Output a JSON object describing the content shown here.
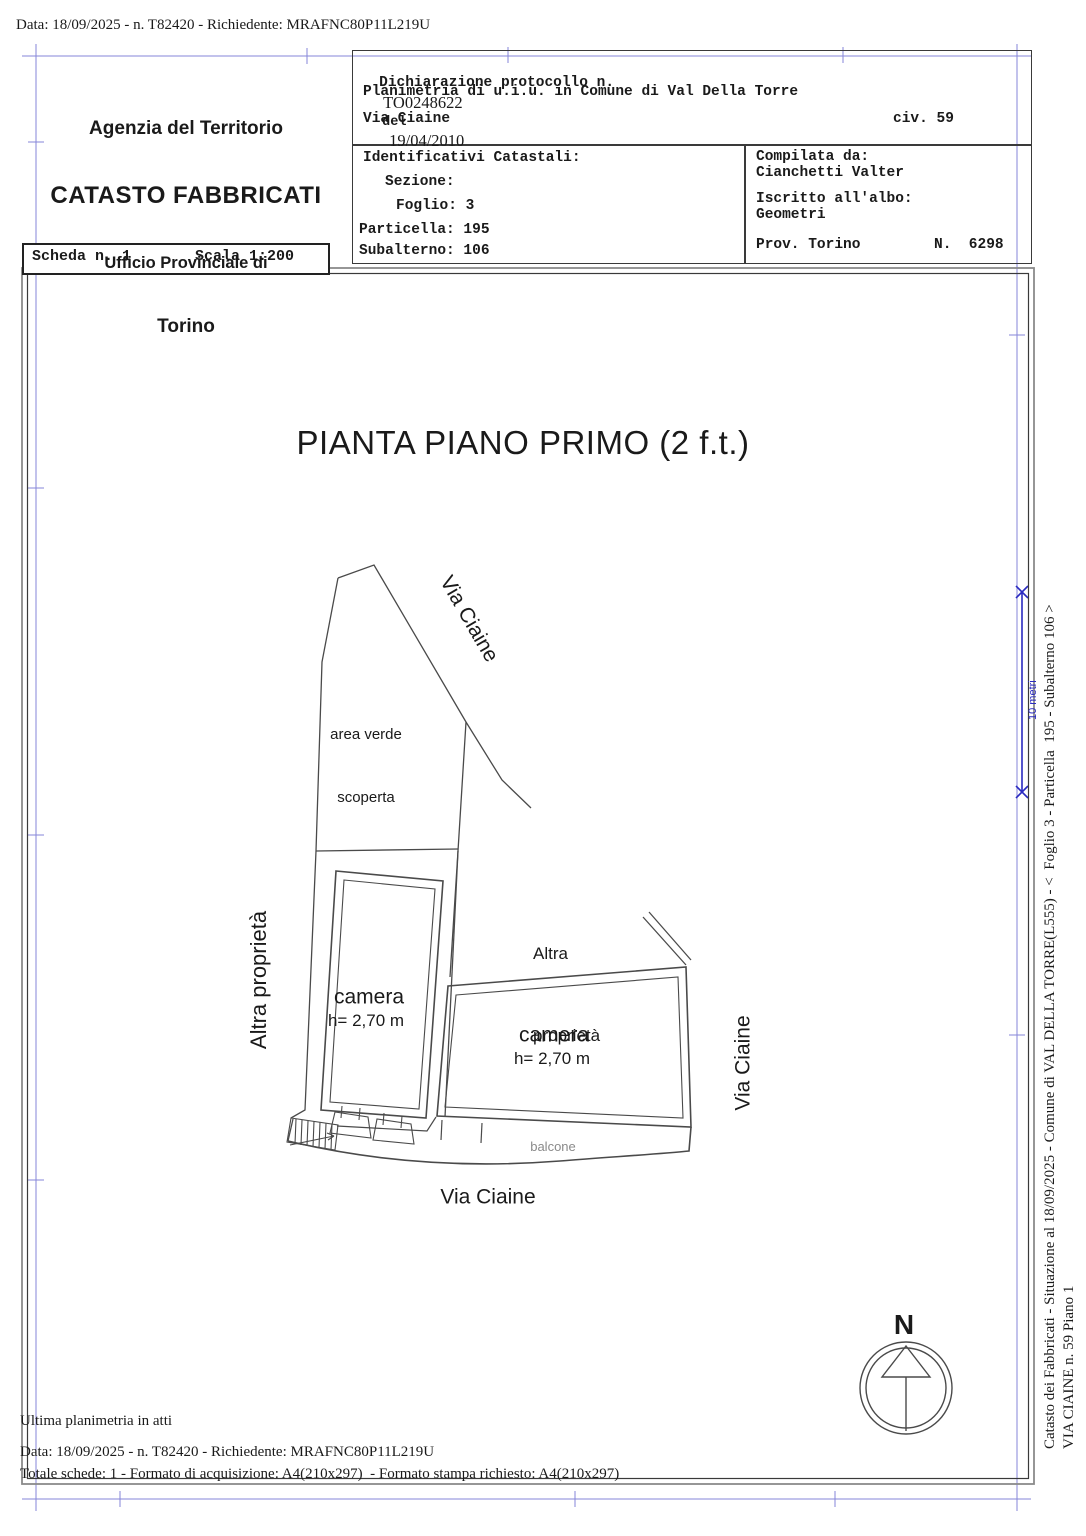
{
  "top_line": "Data: 18/09/2025 - n. T82420 - Richiedente: MRAFNC80P11L219U",
  "header": {
    "agency": {
      "line1": "Agenzia del Territorio",
      "line2": "CATASTO FABBRICATI",
      "line3": "Ufficio Provinciale di",
      "line4": "Torino"
    },
    "declaration": {
      "label": "Dichiarazione protocollo n.",
      "protocol": "TO0248622",
      "del": "del",
      "date": "19/04/2010",
      "line2": "Planimetria di u.i.u. in Comune di Val Della Torre",
      "street": "Via Ciaine",
      "civ": "civ. 59"
    },
    "identifiers": {
      "title": "Identificativi Catastali:",
      "sezione": "Sezione:",
      "foglio": "Foglio: 3",
      "particella": "Particella: 195",
      "subalterno": "Subalterno: 106"
    },
    "compiler": {
      "label": "Compilata da:",
      "name": "Cianchetti Valter",
      "albo_label": "Iscritto all'albo:",
      "albo": "Geometri",
      "prov": "Prov. Torino",
      "num": "N.  6298"
    },
    "scheda": {
      "scheda": "Scheda n. 1",
      "scala": "Scala 1:200"
    }
  },
  "plan": {
    "title": "PIANTA PIANO PRIMO (2 f.t.)",
    "labels": {
      "via_ciaine_top": "Via Ciaine",
      "area_verde_1": "area verde",
      "area_verde_2": "scoperta",
      "altra_prop_left": "Altra proprietà",
      "altra_prop_right_1": "Altra",
      "altra_prop_right_2": "proprietà",
      "camera1": "camera",
      "camera1_h": "h= 2,70 m",
      "camera2": "camera",
      "camera2_h": "h= 2,70 m",
      "balcone": "balcone",
      "via_ciaine_right": "Via Ciaine",
      "via_ciaine_bottom": "Via Ciaine",
      "north": "N"
    },
    "scale_bar_label": "10 metri"
  },
  "footer": {
    "line1": "Ultima planimetria in atti",
    "line2": "Data: 18/09/2025 - n. T82420 - Richiedente: MRAFNC80P11L219U",
    "line3": "Totale schede: 1 - Formato di acquisizione: A4(210x297)  - Formato stampa richiesto: A4(210x297)"
  },
  "sidebar": {
    "line1": "Catasto dei Fabbricati - Situazione al 18/09/2025 - Comune di VAL DELLA TORRE(L555) - <  Foglio 3 - Particella  195 - Subalterno 106 >",
    "line2": "VIA CIAINE n. 59 Piano 1"
  },
  "colors": {
    "frame_blue": "#8686d8",
    "scalebar_blue": "#2a2ac0",
    "ink": "#1a1a1a",
    "plan_line": "#4a4a4a"
  }
}
